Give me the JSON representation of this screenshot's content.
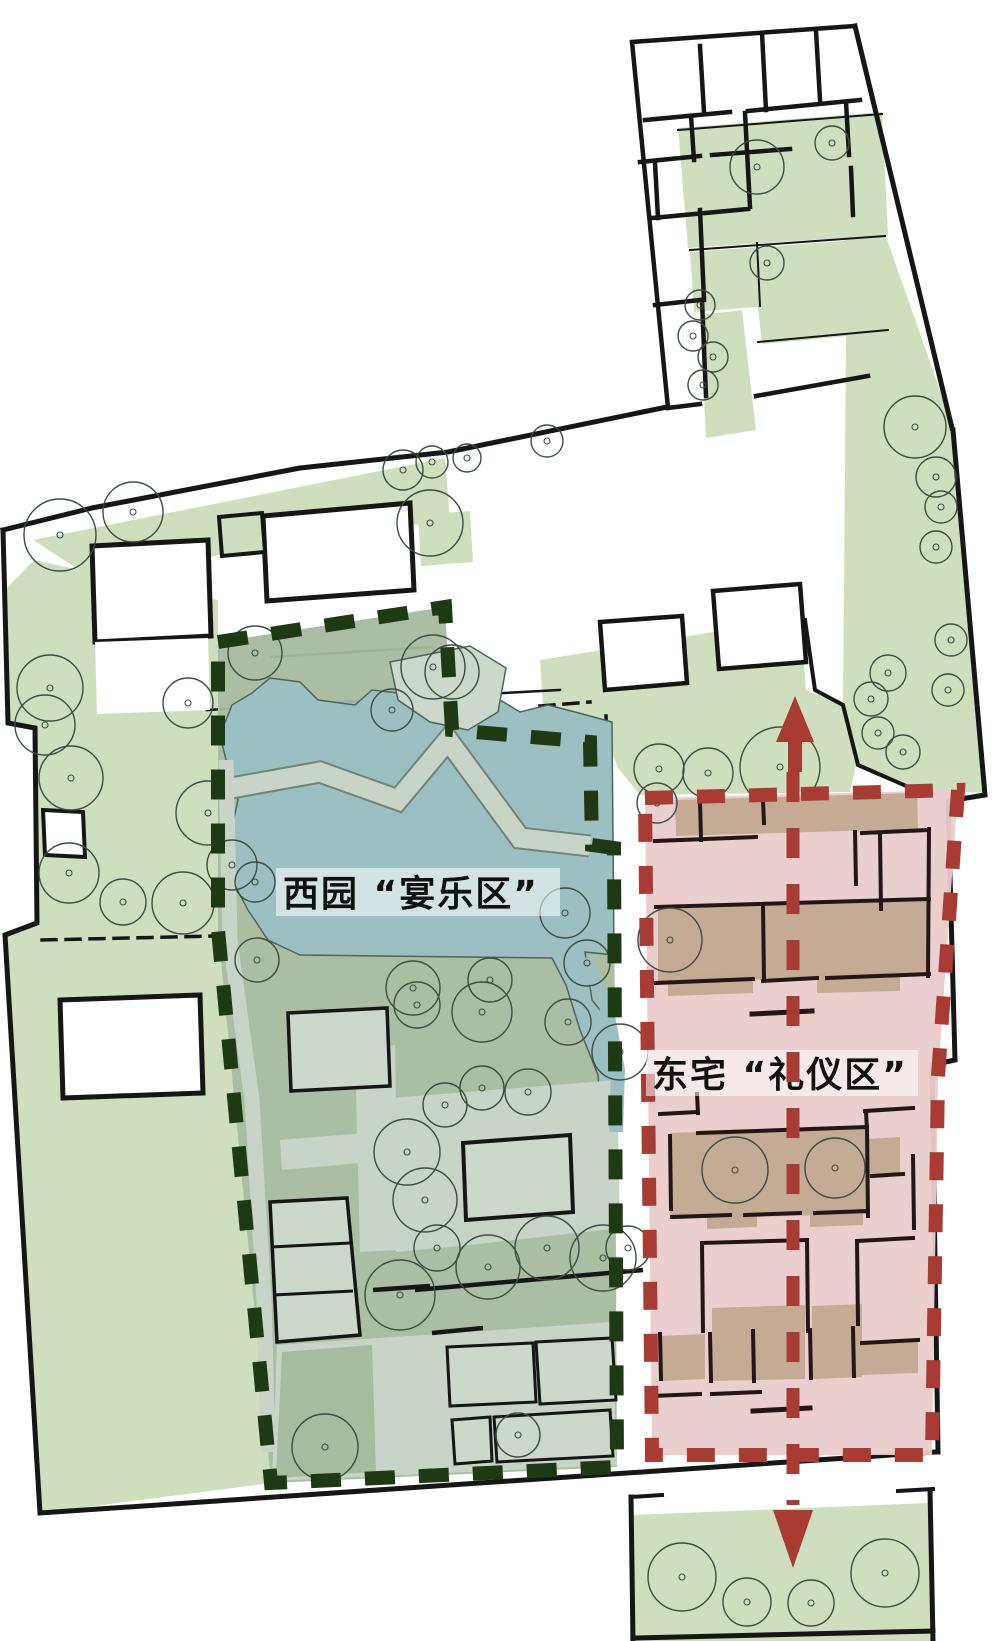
{
  "diagram": {
    "type": "architectural-site-plan-analysis",
    "description": "Plan diagram of a garden-residence complex divided into two analytical zones with a ceremonial axis"
  },
  "zones": {
    "west": {
      "label": "西园 “宴乐区”",
      "name": "west-garden-banquet-zone",
      "border_style": "dashed",
      "border_color": "#1d3a13",
      "fill": "#a7bb9f"
    },
    "east": {
      "label": "东宅 “礼仪区”",
      "name": "east-residence-ceremony-zone",
      "border_style": "dashed",
      "border_color": "#a83c34",
      "fill": "#e9cccb"
    }
  },
  "axis": {
    "name": "central-ceremonial-axis",
    "color": "#a83c34",
    "style": "dashed",
    "arrows": [
      "north",
      "south"
    ]
  },
  "colors": {
    "bg": "#ffffff",
    "wall": "#161616",
    "green_light": "#cfdfbe",
    "garden_fill": "#a7bb9f",
    "path_light": "#c9d4c8",
    "path_edge": "#6f8577",
    "pavilion": "#ccd8cb",
    "pond": "#9cc0c1",
    "pond_edge": "#4a665c",
    "west_border": "#1d3a13",
    "east_fill": "#e9cccb",
    "east_border": "#a83c34",
    "tan": "#c3a98f",
    "axis": "#a83c34",
    "tree": "#3d4d40",
    "label_bg": "rgba(255,255,255,0.55)",
    "text": "#111111"
  },
  "trees": {
    "outside": [
      [
        757,
        167,
        27
      ],
      [
        832,
        143,
        17
      ],
      [
        767,
        263,
        17
      ],
      [
        700,
        305,
        15
      ],
      [
        693,
        336,
        15
      ],
      [
        713,
        357,
        15
      ],
      [
        703,
        385,
        15
      ],
      [
        915,
        427,
        31
      ],
      [
        936,
        477,
        20
      ],
      [
        941,
        507,
        16
      ],
      [
        936,
        547,
        16
      ],
      [
        951,
        640,
        16
      ],
      [
        948,
        690,
        16
      ],
      [
        888,
        673,
        18
      ],
      [
        871,
        699,
        17
      ],
      [
        878,
        733,
        16
      ],
      [
        903,
        752,
        17
      ],
      [
        60,
        535,
        36
      ],
      [
        133,
        512,
        30
      ],
      [
        430,
        523,
        33
      ],
      [
        403,
        470,
        20
      ],
      [
        432,
        462,
        16
      ],
      [
        467,
        458,
        14
      ],
      [
        547,
        441,
        16
      ],
      [
        50,
        688,
        33
      ],
      [
        45,
        725,
        30
      ],
      [
        71,
        778,
        32
      ],
      [
        188,
        703,
        25
      ],
      [
        208,
        813,
        32
      ],
      [
        69,
        873,
        30
      ],
      [
        123,
        902,
        23
      ],
      [
        183,
        903,
        31
      ],
      [
        659,
        769,
        25
      ],
      [
        708,
        773,
        25
      ],
      [
        780,
        767,
        40
      ]
    ],
    "garden": [
      [
        255,
        653,
        27
      ],
      [
        433,
        667,
        32
      ],
      [
        452,
        672,
        27
      ],
      [
        392,
        710,
        21
      ],
      [
        232,
        865,
        25
      ],
      [
        255,
        882,
        20
      ],
      [
        257,
        960,
        22
      ],
      [
        565,
        913,
        25
      ],
      [
        587,
        963,
        23
      ],
      [
        490,
        980,
        22
      ],
      [
        413,
        988,
        27
      ],
      [
        417,
        1005,
        23
      ],
      [
        482,
        1012,
        30
      ],
      [
        568,
        1022,
        23
      ],
      [
        620,
        1052,
        28
      ],
      [
        445,
        1105,
        22
      ],
      [
        482,
        1088,
        22
      ],
      [
        528,
        1092,
        23
      ],
      [
        407,
        1152,
        33
      ],
      [
        425,
        1200,
        32
      ],
      [
        437,
        1248,
        23
      ],
      [
        488,
        1267,
        32
      ],
      [
        547,
        1248,
        32
      ],
      [
        603,
        1258,
        33
      ],
      [
        628,
        1248,
        22
      ],
      [
        400,
        1295,
        35
      ],
      [
        325,
        1447,
        33
      ],
      [
        518,
        1435,
        22
      ]
    ],
    "east": [
      [
        657,
        803,
        20
      ],
      [
        670,
        940,
        32
      ],
      [
        735,
        1170,
        33
      ],
      [
        835,
        1168,
        30
      ]
    ],
    "bottom_court": [
      [
        682,
        1577,
        34
      ],
      [
        747,
        1602,
        24
      ],
      [
        811,
        1603,
        23
      ],
      [
        885,
        1573,
        34
      ]
    ]
  }
}
